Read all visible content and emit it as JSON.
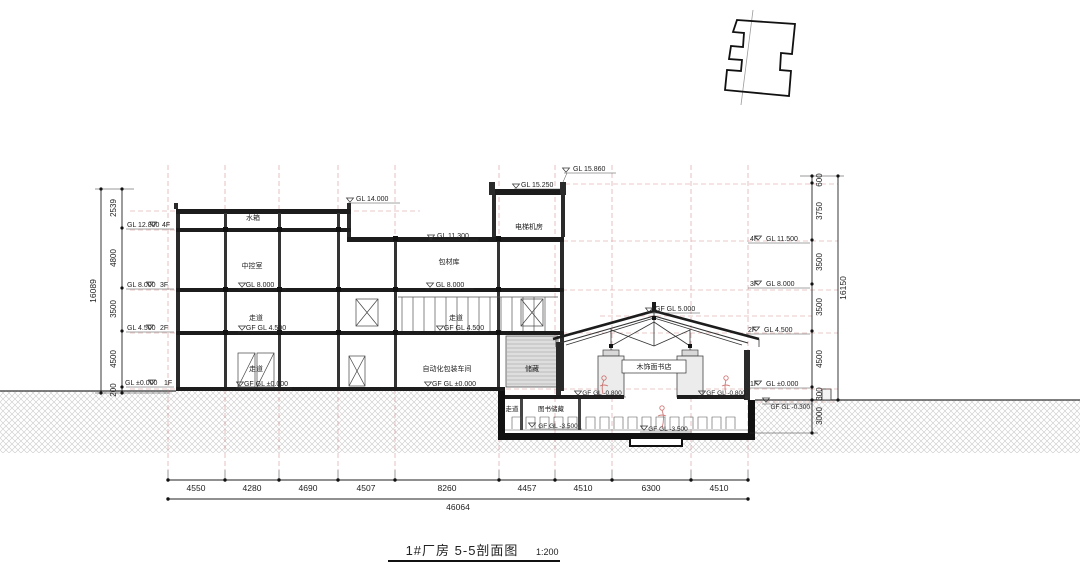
{
  "drawing": {
    "title": "1#厂房 5-5剖面图",
    "scale": "1:200"
  },
  "rooms": {
    "water_tank": "水箱",
    "control_room": "中控室",
    "corridor": "走道",
    "packing_material_warehouse": "包材库",
    "auto_packing_workshop": "自动化包装车间",
    "storage": "储藏",
    "elevator_machine_room": "电梯机房",
    "bookstore": "木饰面书店",
    "book_storage": "图书储藏"
  },
  "levels": {
    "top": {
      "gl_15_860": "GL 15.860",
      "gl_15_250": "GL 15.250",
      "gl_14_000": "GL 14.000",
      "gl_11_300": "GL 11.300",
      "gf_gl_5_000": "GF GL 5.000"
    },
    "left": [
      {
        "value": "GL 12.800",
        "floor": "4F"
      },
      {
        "value": "GL 8.000",
        "floor": "3F"
      },
      {
        "value": "GL 4.500",
        "floor": "2F"
      },
      {
        "value": "GL ±0.000",
        "floor": "1F"
      }
    ],
    "right": [
      {
        "floor": "4F",
        "value": "GL 11.500"
      },
      {
        "floor": "3F",
        "value": "GL 8.000"
      },
      {
        "floor": "2F",
        "value": "GL 4.500"
      },
      {
        "floor": "1F",
        "value": "GL ±0.000"
      }
    ],
    "inline": {
      "gl_8_000": "GL 8.000",
      "gf_gl_4_500": "GF GL 4.500",
      "gf_gl_0": "GF GL ±0.000",
      "gf_gl_m0_800": "GF GL -0.800",
      "gf_gl_m3_500": "GF GL -3.500",
      "gf_gl_m0_300": "GF GL -0.300"
    }
  },
  "dimensions": {
    "bottom": {
      "segments": [
        "4550",
        "4280",
        "4690",
        "4507",
        "8260",
        "4457",
        "4510",
        "6300",
        "4510"
      ],
      "total": "46064"
    },
    "left": {
      "segments": [
        "2539",
        "4800",
        "3500",
        "4500",
        "200"
      ],
      "total": "16089"
    },
    "right": {
      "segments": [
        "600",
        "3750",
        "3500",
        "3500",
        "4500",
        "300",
        "3000"
      ],
      "total": "16150"
    }
  }
}
